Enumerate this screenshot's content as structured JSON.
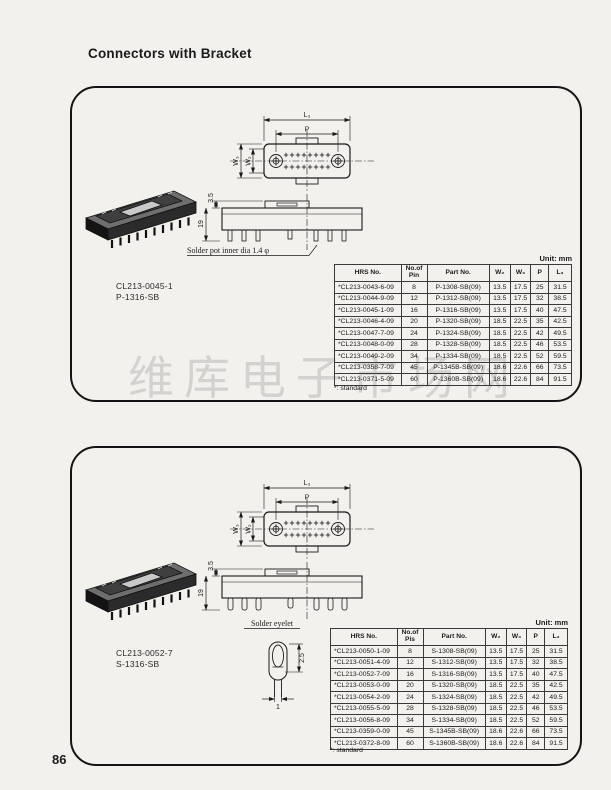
{
  "page": {
    "title": "Connectors with Bracket",
    "page_number": "86",
    "watermark": "维库电子市场网"
  },
  "drawing_labels": {
    "L3": "L₃",
    "P": "P",
    "W2": "W₂",
    "W3": "W₃",
    "h_top": "3.5",
    "h_total": "19"
  },
  "panel1": {
    "model_line1": "CL213-0045-1",
    "model_line2": "P-1316-SB",
    "callout": "Solder pot inner dia 1.4 φ",
    "unit_label": "Unit: mm",
    "footnote": "*: standard",
    "table": {
      "headers": [
        "HRS No.",
        "No.of\nPin",
        "Part No.",
        "W₂",
        "W₃",
        "P",
        "L₃"
      ],
      "rows": [
        [
          "*CL213-0043-6-09",
          "8",
          "P-1308-SB(09)",
          "13.5",
          "17.5",
          "25",
          "31.5"
        ],
        [
          "*CL213-0044-9-09",
          "12",
          "P-1312-SB(09)",
          "13.5",
          "17.5",
          "32",
          "38.5"
        ],
        [
          "*CL213-0045-1-09",
          "16",
          "P-1316-SB(09)",
          "13.5",
          "17.5",
          "40",
          "47.5"
        ],
        [
          "*CL213-0046-4-09",
          "20",
          "P-1320-SB(09)",
          "18.5",
          "22.5",
          "35",
          "42.5"
        ],
        [
          "*CL213-0047-7-09",
          "24",
          "P-1324-SB(09)",
          "18.5",
          "22.5",
          "42",
          "49.5"
        ],
        [
          "*CL213-0048-0-09",
          "28",
          "P-1328-SB(09)",
          "18.5",
          "22.5",
          "46",
          "53.5"
        ],
        [
          "*CL213-0049-2-09",
          "34",
          "P-1334-SB(09)",
          "18.5",
          "22.5",
          "52",
          "59.5"
        ],
        [
          "*CL213-0358-7-09",
          "45",
          "P-1345B-SB(09)",
          "18.6",
          "22.6",
          "66",
          "73.5"
        ],
        [
          "*CL213-0371-5-09",
          "60",
          "P-1360B-SB(09)",
          "18.6",
          "22.6",
          "84",
          "91.5"
        ]
      ]
    }
  },
  "panel2": {
    "model_line1": "CL213-0052-7",
    "model_line2": "S-1316-SB",
    "callout": "Solder eyelet",
    "unit_label": "Unit: mm",
    "footnote": "*: standard",
    "eyelet_dims": {
      "height": "2.5",
      "width": "1"
    },
    "table": {
      "headers": [
        "HRS No.",
        "No.of\nPis",
        "Part No.",
        "W₂",
        "W₃",
        "P",
        "L₃"
      ],
      "rows": [
        [
          "*CL213-0050-1-09",
          "8",
          "S-1308-SB(09)",
          "13.5",
          "17.5",
          "25",
          "31.5"
        ],
        [
          "*CL213-0051-4-09",
          "12",
          "S-1312-SB(09)",
          "13.5",
          "17.5",
          "32",
          "38.5"
        ],
        [
          "*CL213-0052-7-09",
          "16",
          "S-1316-SB(09)",
          "13.5",
          "17.5",
          "40",
          "47.5"
        ],
        [
          "*CL213-0053-0-09",
          "20",
          "S-1320-SB(09)",
          "18.5",
          "22.5",
          "35",
          "42.5"
        ],
        [
          "*CL213-0054-2-09",
          "24",
          "S-1324-SB(09)",
          "18.5",
          "22.5",
          "42",
          "49.5"
        ],
        [
          "*CL213-0055-5-09",
          "28",
          "S-1328-SB(09)",
          "18.5",
          "22.5",
          "46",
          "53.5"
        ],
        [
          "*CL213-0056-8-09",
          "34",
          "S-1334-SB(09)",
          "18.5",
          "22.5",
          "52",
          "59.5"
        ],
        [
          "*CL213-0359-0-09",
          "45",
          "S-1345B-SB(09)",
          "18.6",
          "22.6",
          "66",
          "73.5"
        ],
        [
          "*CL213-0372-8-09",
          "60",
          "S-1360B-SB(09)",
          "18.6",
          "22.6",
          "84",
          "91.5"
        ]
      ]
    }
  }
}
